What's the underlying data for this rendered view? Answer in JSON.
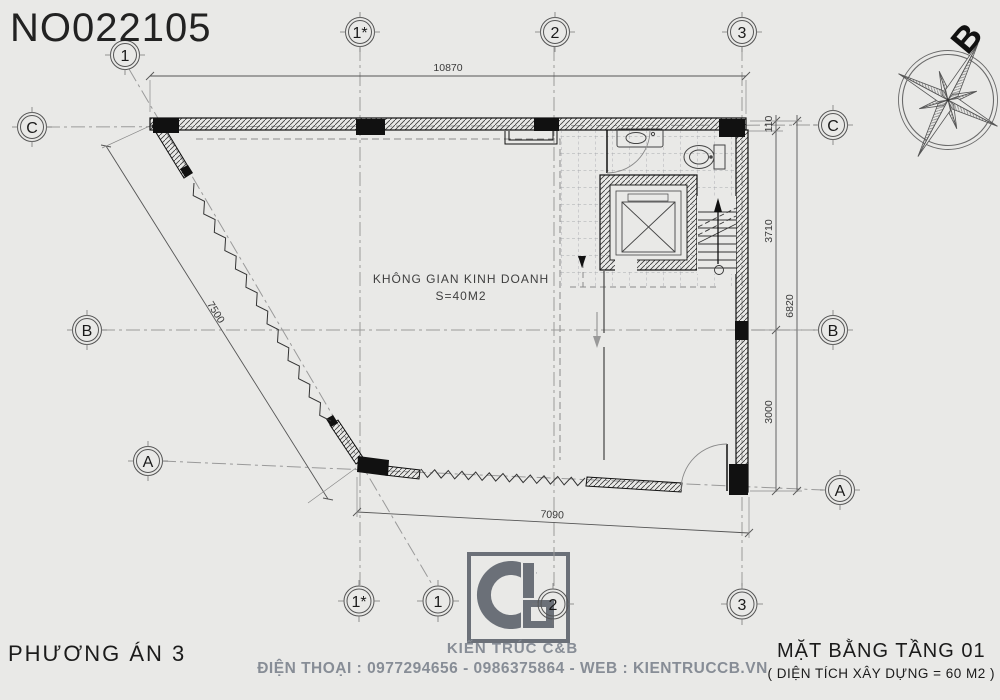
{
  "title": "NO022105",
  "compass": {
    "north_label": "B"
  },
  "plan": {
    "room": {
      "name": "KHÔNG GIAN KINH DOANH",
      "area": "S=40M2"
    },
    "dimensions": {
      "top": "10870",
      "diagonal": "7500",
      "bottom": "7090",
      "right_offset": "110",
      "right_upper": "3710",
      "right_total": "6820",
      "right_lower": "3000"
    },
    "grid": {
      "top": [
        "1",
        "1*",
        "2",
        "3"
      ],
      "bottom": [
        "1*",
        "1",
        "2",
        "3"
      ],
      "left": [
        "C",
        "B",
        "A"
      ],
      "right": [
        "C",
        "B",
        "A"
      ]
    }
  },
  "footer": {
    "left": "PHƯƠNG ÁN 3",
    "brand": "KIẾN TRÚC C&B",
    "contact": "ĐIỆN THOẠI : 0977294656 - 0986375864 - WEB : KIENTRUCCB.VN",
    "right_title": "MẶT BẰNG TẦNG 01",
    "right_subtitle": "( DIỆN TÍCH XÂY DỰNG = 60 M2 )"
  },
  "colors": {
    "background": "#e9e9e7",
    "wall_line": "#1a1a1a",
    "dimension_line": "#555555",
    "axis_line": "#999999",
    "footer_gray": "#878d96",
    "logo_gray": "#6b7078"
  }
}
